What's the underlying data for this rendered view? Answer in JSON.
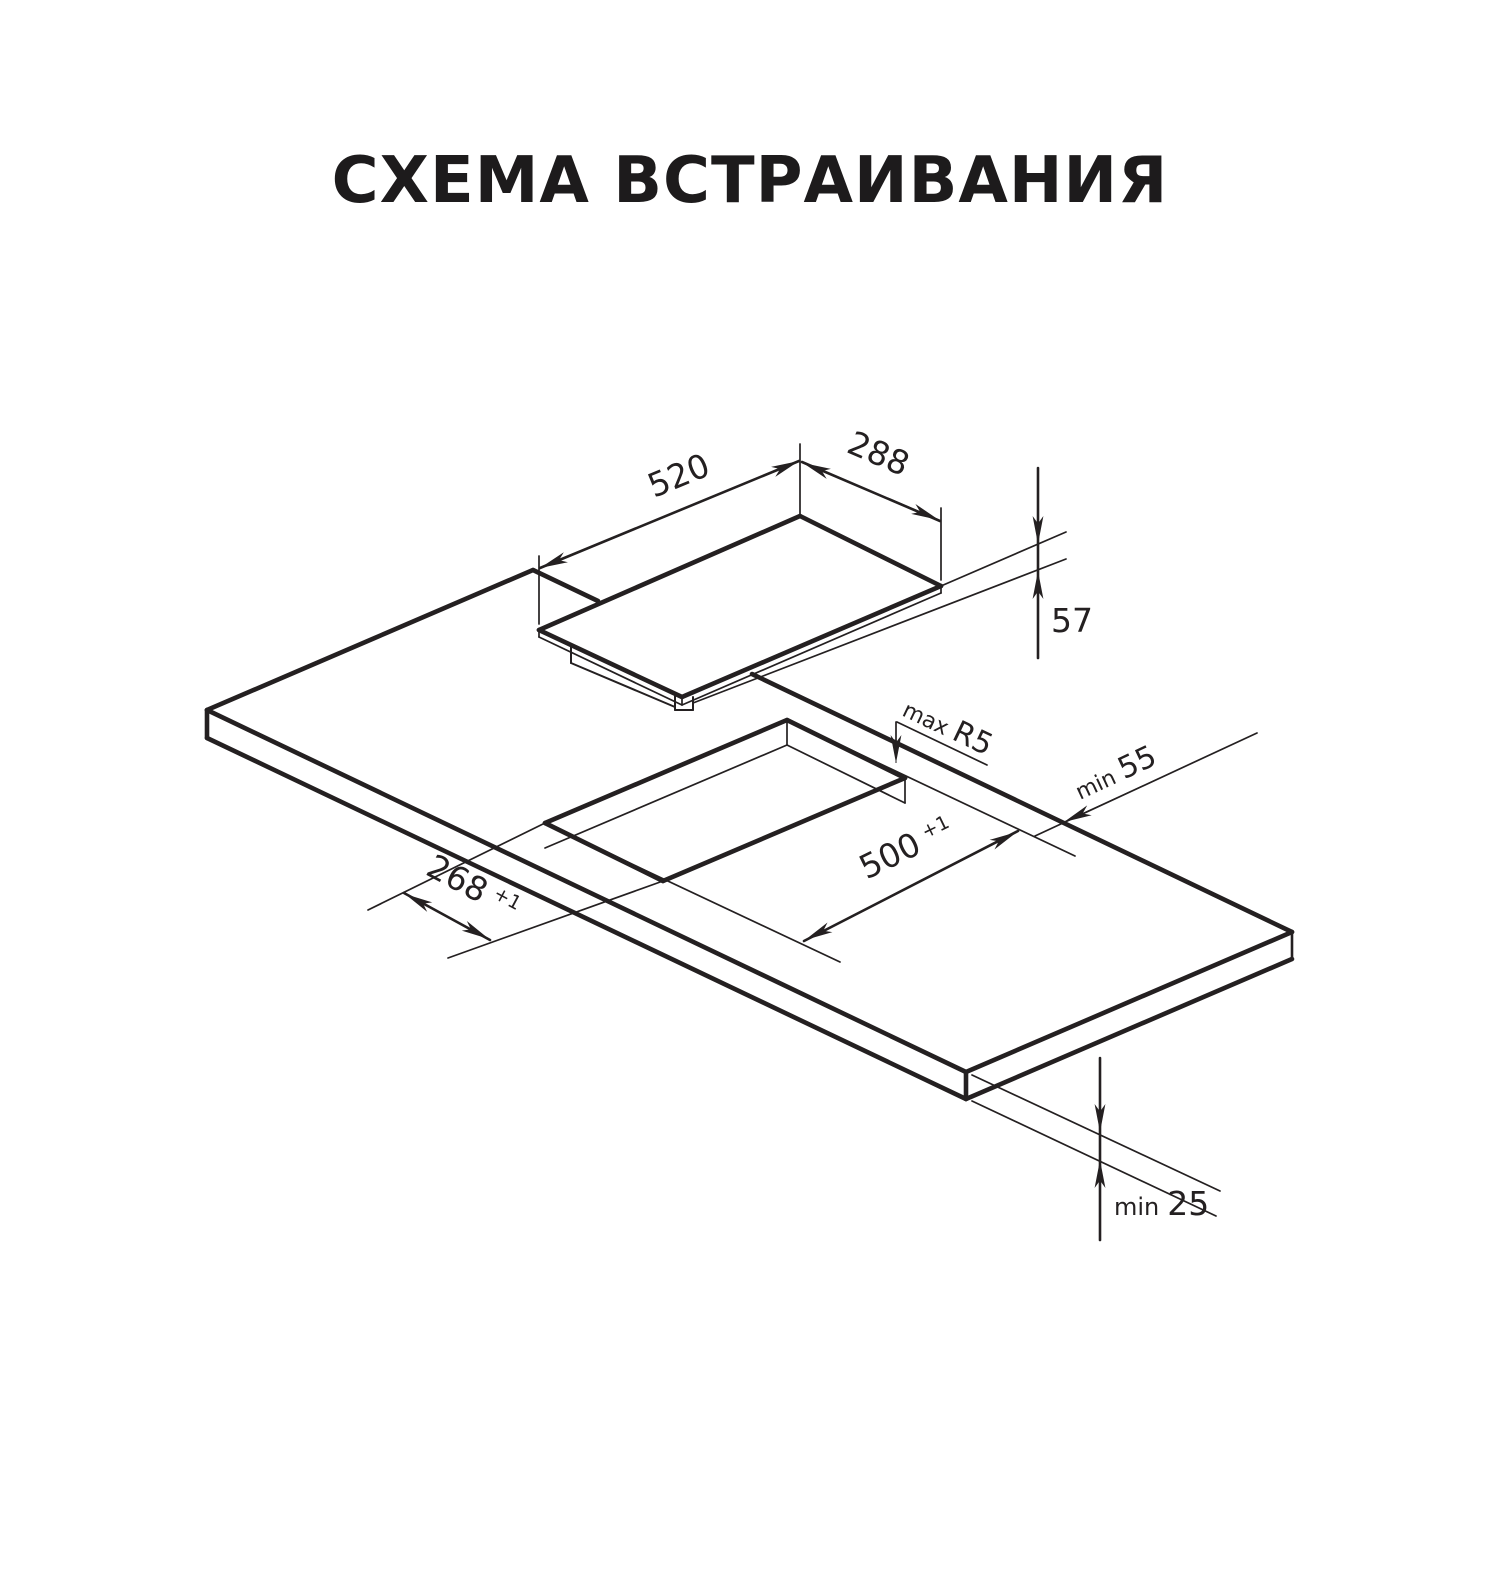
{
  "page": {
    "background": "#ffffff",
    "line_color": "#242021",
    "title_color": "#1d1b1c"
  },
  "title": "СХЕМА ВСТРАИВАНИЯ",
  "diagram": {
    "hob": {
      "width_label": "520",
      "depth_label": "288",
      "height_label": "57"
    },
    "cutout": {
      "width_label": "500",
      "width_tolerance": "+1",
      "depth_label": "268",
      "depth_tolerance": "+1",
      "corner_radius_prefix": "max",
      "corner_radius_label": "R5"
    },
    "clearances": {
      "side_prefix": "min",
      "side_label": "55",
      "below_prefix": "min",
      "below_label": "25"
    }
  }
}
